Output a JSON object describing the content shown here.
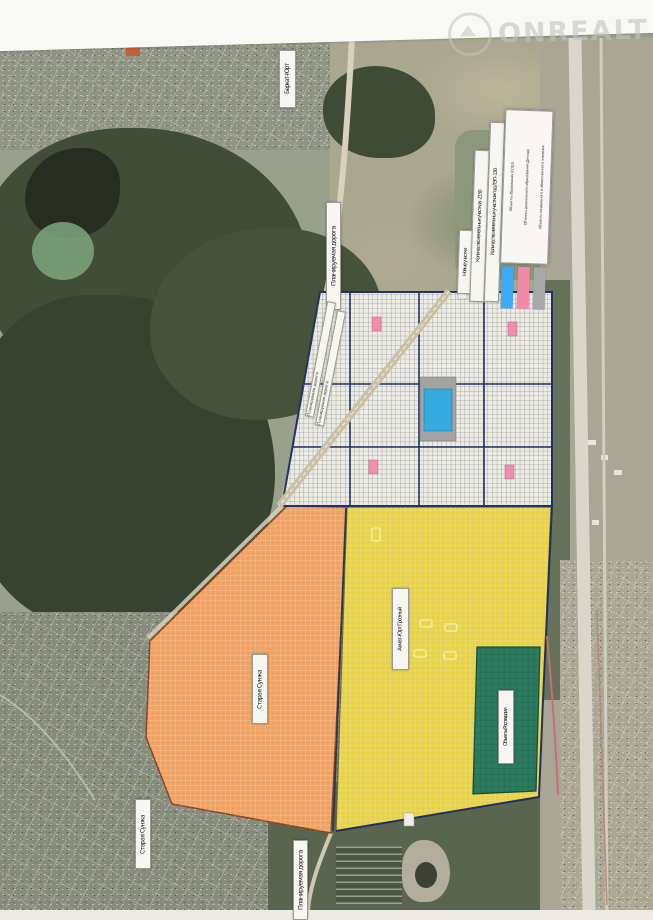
{
  "watermark": {
    "brand": "ONREALT"
  },
  "map": {
    "place_labels": {
      "berkat_yurt": "Беркат-Юрт",
      "staraya_sunzha": "Старая Сунжа",
      "akhmat_yurt": "Ахмат-Юрт Грозный",
      "rosgvardia": "Объекты Росгвардии"
    },
    "road_labels": {
      "planned_road": "Планируемая дорога"
    },
    "info_strips": [
      "Новые участки",
      "Количество земельных участков - 2150",
      "Количество земельных участков под ЛЭП - 130"
    ],
    "legend": {
      "items": [
        {
          "label": "Объекты образования (СОШ)",
          "color": "#3fa9f5"
        },
        {
          "label": "Объекты дошкольного образования (Детсад)",
          "color": "#f08aa8"
        },
        {
          "label": "Объекты социального и общественного значения",
          "color": "#a8a8a8"
        }
      ]
    },
    "zones": {
      "grid_parcels": "#edece4",
      "new_plots_orange": "#efa263",
      "new_plots_yellow": "#e7d24b",
      "rosgvardia_green": "#2b7b61",
      "boundary": "#223061"
    },
    "markers": {
      "school_blue": "#35abdf",
      "kindergarten_pink": "#ef8fb0",
      "social_gray": "#a3a3a3"
    }
  }
}
